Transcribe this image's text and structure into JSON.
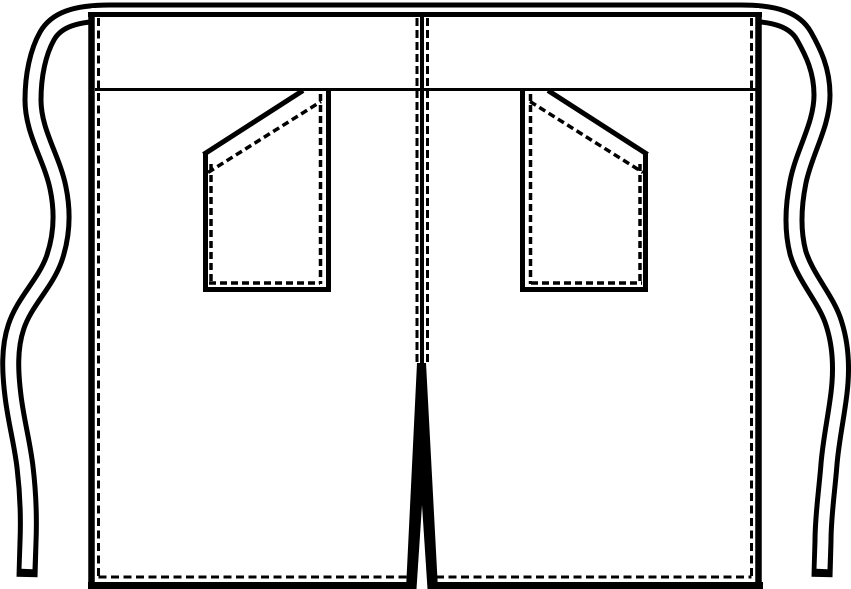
{
  "meta": {
    "title": "Technical flat sketch: waist apron with two slant pockets, waist ties and center vent",
    "canvas": {
      "width": 851,
      "height": 589
    },
    "colors": {
      "line": "#000000",
      "background": "#ffffff"
    }
  },
  "drawing": {
    "shapes": [
      {
        "name": "waist-tie-ribbon-outline",
        "kind": "path",
        "stroke": "#000000",
        "width": 21,
        "join": "round",
        "fill": "none",
        "d": "M 27,577 L 28,542 C 29,517 28,492 25,467 C 22,442 16,421 13,396 C 10,372 9,348 16,327 C 24,302 45,284 54,259 C 62,236 63,212 58,188 C 52,158 33,132 33,100 C 33,75 38,52 47,36 C 56,20 75,13 110,13 L 741,13 C 776,13 795,20 804,36 C 813,52 822,70 822,95 C 822,125 804,152 798,182 C 793,207 792,230 798,253 C 806,279 827,300 834,324 C 841,346 842,368 839,393 C 836,418 831,440 829,464 C 827,490 823,516 823,541 L 822,577"
      },
      {
        "name": "waist-tie-ribbon-core",
        "kind": "path",
        "stroke": "#ffffff",
        "width": 11,
        "join": "round",
        "fill": "none",
        "d": "M 27,569 L 28,542 C 29,517 28,492 25,467 C 22,442 16,421 13,396 C 10,372 9,348 16,327 C 24,302 45,284 54,259 C 62,236 63,212 58,188 C 52,158 33,132 33,100 C 33,75 38,52 47,36 C 56,20 75,13 110,13 L 741,13 C 776,13 795,20 804,36 C 813,52 822,70 822,95 C 822,125 804,152 798,182 C 793,207 792,230 798,253 C 806,279 827,300 834,324 C 841,346 842,368 839,393 C 836,418 831,440 829,464 C 827,490 823,516 823,541 L 822,569"
      },
      {
        "name": "apron-body-fill",
        "kind": "path",
        "stroke": "",
        "width": 0,
        "fill": "#ffffff",
        "d": "M 91.5,8 L 759,8 L 759,586 L 91.5,586 Z"
      },
      {
        "name": "apron-top-edge",
        "kind": "path",
        "stroke": "#000000",
        "width": 5,
        "fill": "none",
        "d": "M 88,14.5 L 762,14.5"
      },
      {
        "name": "apron-left-edge",
        "kind": "path",
        "stroke": "#000000",
        "width": 6.5,
        "fill": "none",
        "d": "M 91.5,12 L 91.5,589"
      },
      {
        "name": "apron-right-edge",
        "kind": "path",
        "stroke": "#000000",
        "width": 6.5,
        "fill": "none",
        "d": "M 758.5,12 L 758.5,589"
      },
      {
        "name": "apron-bottom-hem-edge",
        "kind": "path",
        "stroke": "#000000",
        "width": 7,
        "fill": "none",
        "d": "M 88,585.5 L 763,585.5"
      },
      {
        "name": "left-side-stitch-line",
        "kind": "path",
        "stroke": "#000000",
        "width": 3,
        "dash": "8 4.5",
        "fill": "none",
        "d": "M 98.5,18 L 98.5,578"
      },
      {
        "name": "right-side-stitch-line",
        "kind": "path",
        "stroke": "#000000",
        "width": 3,
        "dash": "8 4.5",
        "fill": "none",
        "d": "M 751.5,18 L 751.5,578"
      },
      {
        "name": "bottom-hem-stitch-line",
        "kind": "path",
        "stroke": "#000000",
        "width": 3,
        "dash": "8 4.5",
        "fill": "none",
        "d": "M 98.5,577 L 751.5,577"
      },
      {
        "name": "waistband-seam-line",
        "kind": "path",
        "stroke": "#000000",
        "width": 3,
        "fill": "none",
        "d": "M 95,89.5 L 756,89.5"
      },
      {
        "name": "center-front-seam-line",
        "kind": "path",
        "stroke": "#000000",
        "width": 4,
        "fill": "none",
        "d": "M 422,17 L 422,365"
      },
      {
        "name": "center-stitch-line-left",
        "kind": "path",
        "stroke": "#000000",
        "width": 3,
        "dash": "8 4",
        "fill": "none",
        "d": "M 417,18 L 417,365"
      },
      {
        "name": "center-stitch-line-right",
        "kind": "path",
        "stroke": "#000000",
        "width": 3,
        "dash": "8 4",
        "fill": "none",
        "d": "M 427.5,18 L 427.5,365"
      },
      {
        "name": "left-pocket-right-edge",
        "kind": "path",
        "stroke": "#000000",
        "width": 5,
        "fill": "none",
        "d": "M 328.5,90 L 328.5,291.5"
      },
      {
        "name": "left-pocket-left-edge",
        "kind": "path",
        "stroke": "#000000",
        "width": 5,
        "fill": "none",
        "d": "M 205.5,152 L 205.5,291.5"
      },
      {
        "name": "left-pocket-bottom-edge",
        "kind": "path",
        "stroke": "#000000",
        "width": 5,
        "fill": "none",
        "d": "M 203,289.5 L 331,289.5"
      },
      {
        "name": "left-pocket-slant-opening",
        "kind": "path",
        "stroke": "#000000",
        "width": 5,
        "fill": "none",
        "d": "M 203.5,154.5 L 303,90.5"
      },
      {
        "name": "left-pocket-stitch-right",
        "kind": "path",
        "stroke": "#000000",
        "width": 3.5,
        "dash": "7 4",
        "fill": "none",
        "d": "M 320.5,94 L 320.5,284"
      },
      {
        "name": "left-pocket-stitch-left",
        "kind": "path",
        "stroke": "#000000",
        "width": 3.5,
        "dash": "7 4",
        "fill": "none",
        "d": "M 211,164 L 211,284"
      },
      {
        "name": "left-pocket-stitch-bottom",
        "kind": "path",
        "stroke": "#000000",
        "width": 3.5,
        "dash": "7 4",
        "fill": "none",
        "d": "M 209,283 L 320,283"
      },
      {
        "name": "left-pocket-stitch-slant",
        "kind": "path",
        "stroke": "#000000",
        "width": 3.5,
        "dash": "7 4",
        "fill": "none",
        "d": "M 208,172.5 L 321,101.5"
      },
      {
        "name": "right-pocket-left-edge",
        "kind": "path",
        "stroke": "#000000",
        "width": 5,
        "fill": "none",
        "d": "M 522.5,90 L 522.5,291.5"
      },
      {
        "name": "right-pocket-right-edge",
        "kind": "path",
        "stroke": "#000000",
        "width": 5,
        "fill": "none",
        "d": "M 645.5,152 L 645.5,291.5"
      },
      {
        "name": "right-pocket-bottom-edge",
        "kind": "path",
        "stroke": "#000000",
        "width": 5,
        "fill": "none",
        "d": "M 520,289.5 L 648,289.5"
      },
      {
        "name": "right-pocket-slant-opening",
        "kind": "path",
        "stroke": "#000000",
        "width": 5,
        "fill": "none",
        "d": "M 548,90.5 L 647.5,154.5"
      },
      {
        "name": "right-pocket-stitch-left",
        "kind": "path",
        "stroke": "#000000",
        "width": 3.5,
        "dash": "7 4",
        "fill": "none",
        "d": "M 530.5,94 L 530.5,284"
      },
      {
        "name": "right-pocket-stitch-right",
        "kind": "path",
        "stroke": "#000000",
        "width": 3.5,
        "dash": "7 4",
        "fill": "none",
        "d": "M 640,164 L 640,284"
      },
      {
        "name": "right-pocket-stitch-bottom",
        "kind": "path",
        "stroke": "#000000",
        "width": 3.5,
        "dash": "7 4",
        "fill": "none",
        "d": "M 531,283 L 642,283"
      },
      {
        "name": "right-pocket-stitch-slant",
        "kind": "path",
        "stroke": "#000000",
        "width": 3.5,
        "dash": "7 4",
        "fill": "none",
        "d": "M 530,101.5 L 643,172.5"
      },
      {
        "name": "center-vent-wedge",
        "kind": "polygon",
        "stroke": "",
        "width": 0,
        "fill": "#000000",
        "points": "417,363 426,363 438,589 406,589"
      },
      {
        "name": "center-vent-gap",
        "kind": "polygon",
        "stroke": "",
        "width": 0,
        "fill": "#ffffff",
        "points": "422,505 427.5,589 416.5,589"
      }
    ]
  }
}
